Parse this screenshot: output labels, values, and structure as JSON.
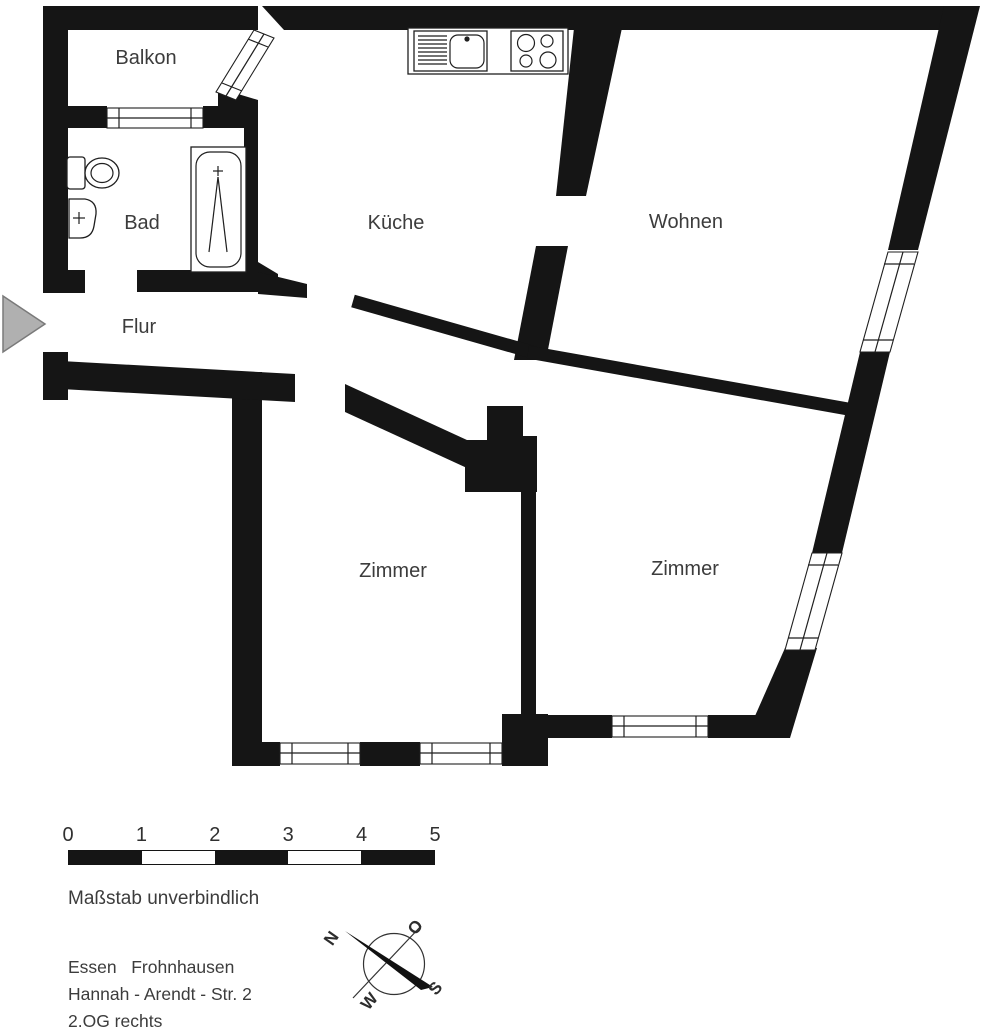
{
  "floorplan": {
    "rooms": {
      "balkon": "Balkon",
      "bad": "Bad",
      "kueche": "Küche",
      "wohnen": "Wohnen",
      "flur": "Flur",
      "zimmer_links": "Zimmer",
      "zimmer_rechts": "Zimmer"
    },
    "colors": {
      "wall": "#151515",
      "label_text": "#3c3c3c",
      "entrance_arrow_fill": "#b0b0b0",
      "entrance_arrow_stroke": "#7a7a7a"
    }
  },
  "scale_bar": {
    "ticks": [
      "0",
      "1",
      "2",
      "3",
      "4",
      "5"
    ],
    "note": "Maßstab unverbindlich"
  },
  "compass": {
    "n": "N",
    "o": "O",
    "s": "S",
    "w": "W"
  },
  "address": {
    "line1": "Essen   Frohnhausen",
    "line2": "Hannah - Arendt - Str. 2",
    "line3": "2.OG rechts"
  }
}
